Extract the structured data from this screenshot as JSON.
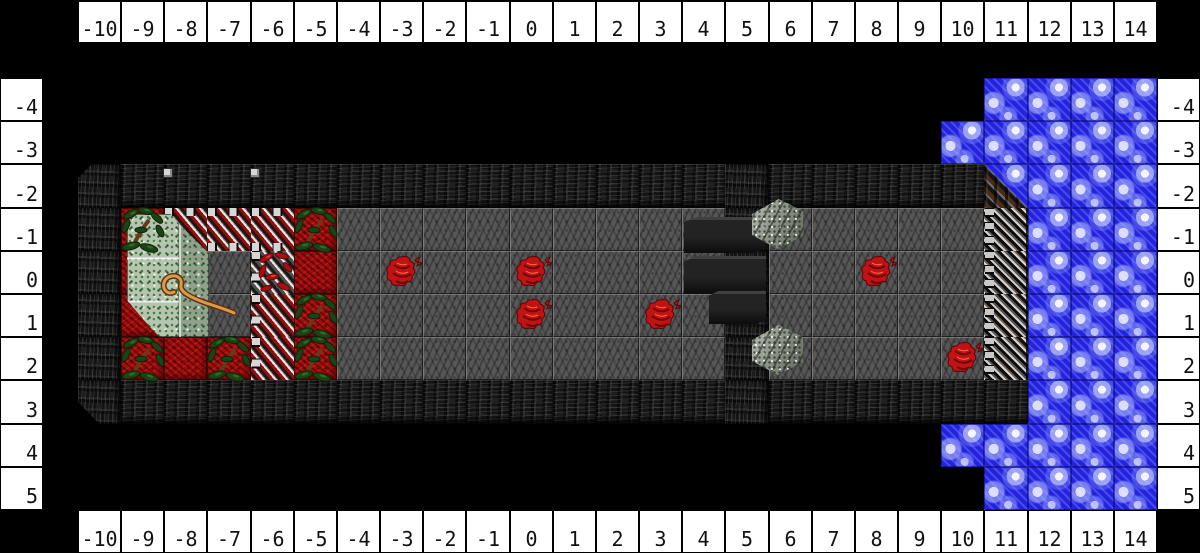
{
  "rulers": {
    "column_labels": [
      "-10",
      "-9",
      "-8",
      "-7",
      "-6",
      "-5",
      "-4",
      "-3",
      "-2",
      "-1",
      "0",
      "1",
      "2",
      "3",
      "4",
      "5",
      "6",
      "7",
      "8",
      "9",
      "10",
      "11",
      "12",
      "13",
      "14"
    ],
    "row_labels": [
      "-4",
      "-3",
      "-2",
      "-1",
      "0",
      "1",
      "2",
      "3",
      "4",
      "5"
    ]
  },
  "map": {
    "legend": {
      ".": "void",
      "#": "rock-wall",
      "~": "water",
      "g": "stone-floor",
      "r": "red-carpet",
      "H": "iron-grate-horizontal",
      "V": "iron-grate-vertical-over-red",
      "v": "iron-grate-vertical-over-stone",
      "G": "iron-grate-east-wall",
      "C": "wall-water-corner"
    },
    "col_coords": [
      -10,
      -9,
      -8,
      -7,
      -6,
      -5,
      -4,
      -3,
      -2,
      -1,
      0,
      1,
      2,
      3,
      4,
      5,
      6,
      7,
      8,
      9,
      10,
      11,
      12,
      13,
      14
    ],
    "row_coords": [
      -4,
      -3,
      -2,
      -1,
      0,
      1,
      2,
      3,
      4,
      5
    ],
    "rows": [
      ".....................~~~~",
      "....................~~~~~",
      "#####################C~~~",
      "#rHHHrggggggggg#gggggG~~~",
      "#rrgvrggggggggg#gggggG~~~",
      "#rrgVrggggggggg#gggggG~~~",
      "#rrrVrggggggggg#gggggG~~~",
      "######################~~~",
      "....................~~~~~",
      ".....................~~~~"
    ],
    "beveled_corners": [
      {
        "col": -10,
        "row": -2,
        "corner": "tl"
      },
      {
        "col": -10,
        "row": 3,
        "corner": "bl"
      }
    ]
  },
  "sprites": {
    "creatures": [
      {
        "col": -3,
        "row": 0
      },
      {
        "col": 0,
        "row": 0
      },
      {
        "col": 0,
        "row": 1
      },
      {
        "col": 3,
        "row": 1
      },
      {
        "col": 8,
        "row": 0
      },
      {
        "col": 10,
        "row": 2
      }
    ],
    "plants": [
      {
        "col": -9,
        "row": -1
      },
      {
        "col": -5,
        "row": -1
      },
      {
        "col": -5,
        "row": 1
      },
      {
        "col": -9,
        "row": 2
      },
      {
        "col": -7,
        "row": 2
      },
      {
        "col": -5,
        "row": 2
      }
    ],
    "red_vines": [
      {
        "col": -6,
        "row": 0
      }
    ],
    "moss_block": {
      "x": 127,
      "y": 214,
      "w": 82,
      "h": 123
    },
    "cane": {
      "x": 156,
      "y": 270,
      "w": 84,
      "h": 50
    },
    "dark_slabs": [
      {
        "x": 684,
        "y": 217,
        "w": 82,
        "h": 36
      },
      {
        "x": 684,
        "y": 256,
        "w": 82,
        "h": 38
      },
      {
        "x": 709,
        "y": 291,
        "w": 57,
        "h": 33
      }
    ],
    "stone_steps": [
      {
        "x": 752,
        "y": 199,
        "w": 51,
        "h": 50
      },
      {
        "x": 752,
        "y": 325,
        "w": 51,
        "h": 50
      }
    ],
    "wall_posts": [
      {
        "x": 163,
        "y": 168
      },
      {
        "x": 250,
        "y": 168
      }
    ]
  },
  "colors": {
    "background": "#000000",
    "ruler_bg": "#ffffff",
    "ruler_border": "#000000",
    "ruler_text": "#111111",
    "water_blue": "#2222e0",
    "stone_floor": "#575757",
    "wall_rock": "#131313",
    "red_carpet": "#a50d0d",
    "moss_green": "#b7c4b0",
    "plant_green": "#1c4316",
    "creature_red": "#c01313",
    "grate_metal": "#d6d6d6",
    "wood_brown": "#5a3012",
    "cane_tan": "#d89a4c"
  }
}
